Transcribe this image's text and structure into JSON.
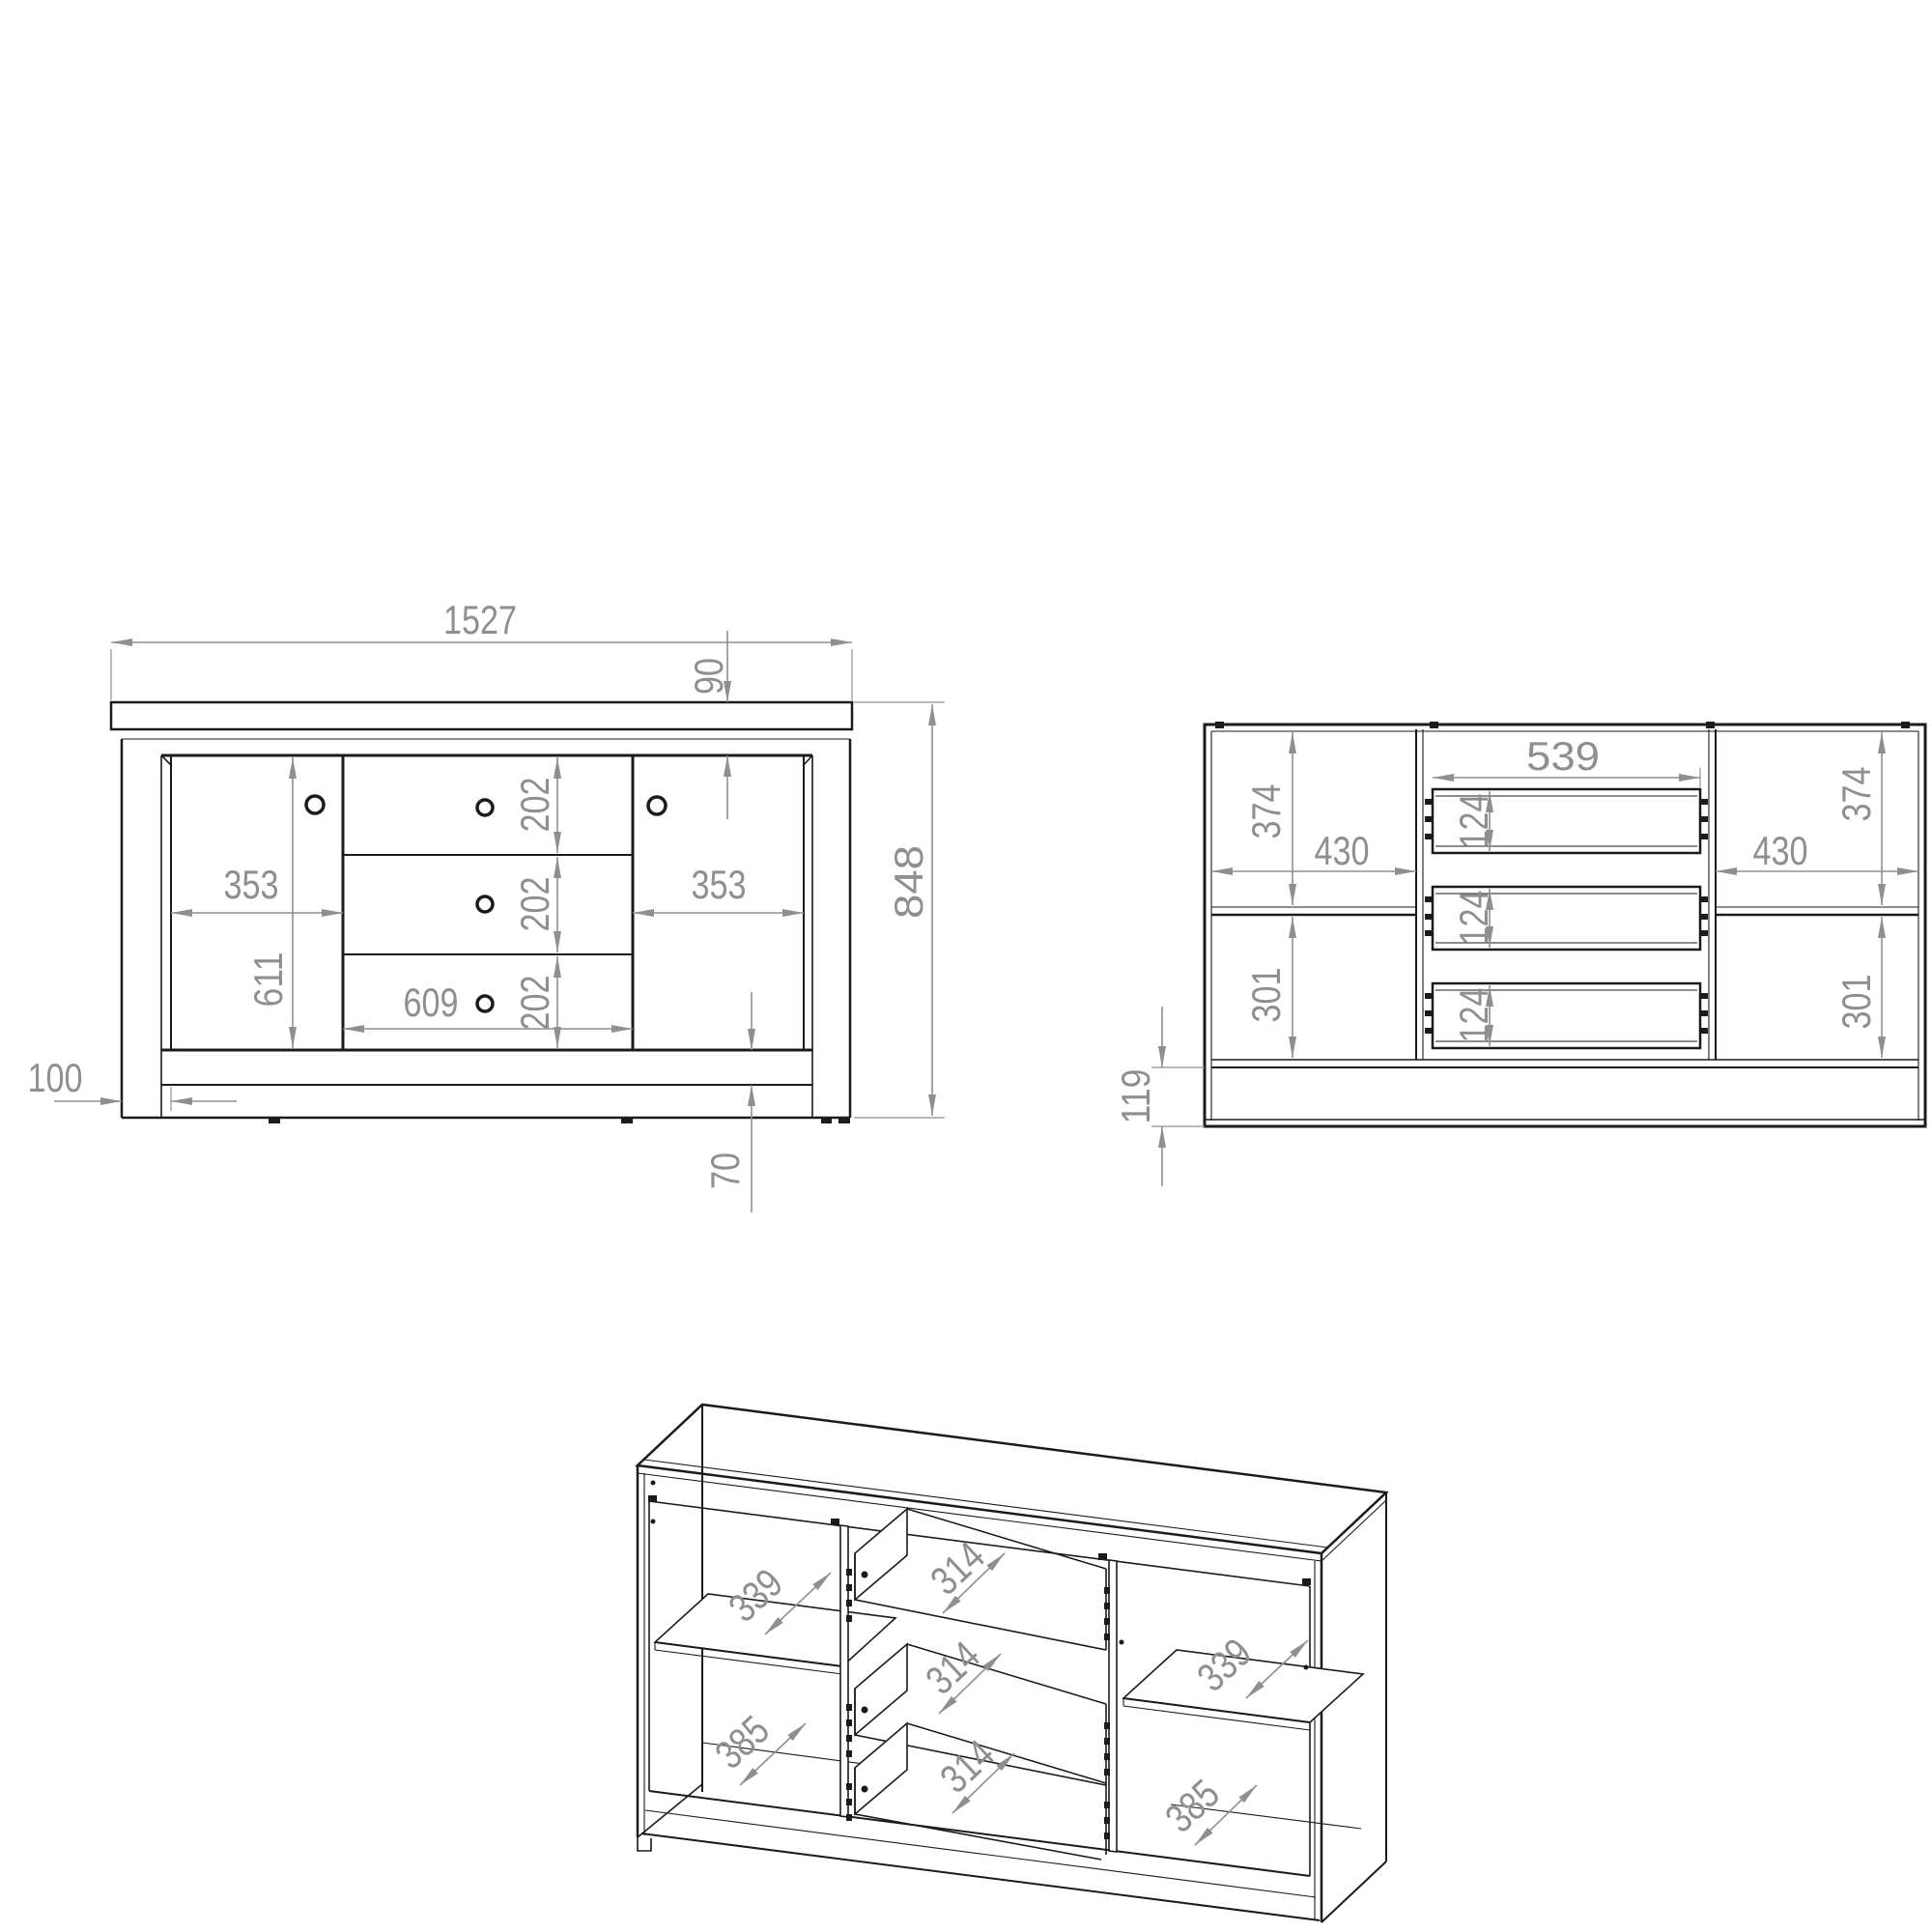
{
  "colors": {
    "line": "#1b1b1b",
    "dimension": "#8f8f8f",
    "background": "#ffffff"
  },
  "front_view": {
    "total_width": "1527",
    "top_panel_height": "90",
    "drawer_heights": [
      "202",
      "202",
      "202"
    ],
    "left_door_width": "353",
    "right_door_width": "353",
    "door_height": "611",
    "drawer_width": "609",
    "total_height": "848",
    "side_width": "100",
    "bottom_rail_height": "70"
  },
  "internal_view": {
    "drawer_opening_width": "539",
    "drawer_box_heights": [
      "124",
      "124",
      "124"
    ],
    "left": {
      "top_compartment_height": "374",
      "width": "430",
      "bottom_compartment_height": "301"
    },
    "right": {
      "top_compartment_height": "374",
      "width": "430",
      "bottom_compartment_height": "301"
    },
    "plinth_height": "119"
  },
  "iso_view": {
    "left": {
      "shelf_depth": "339",
      "bottom_depth": "385"
    },
    "drawer_depths": [
      "314",
      "314",
      "314"
    ],
    "right": {
      "shelf_depth": "339",
      "bottom_depth": "385"
    }
  }
}
